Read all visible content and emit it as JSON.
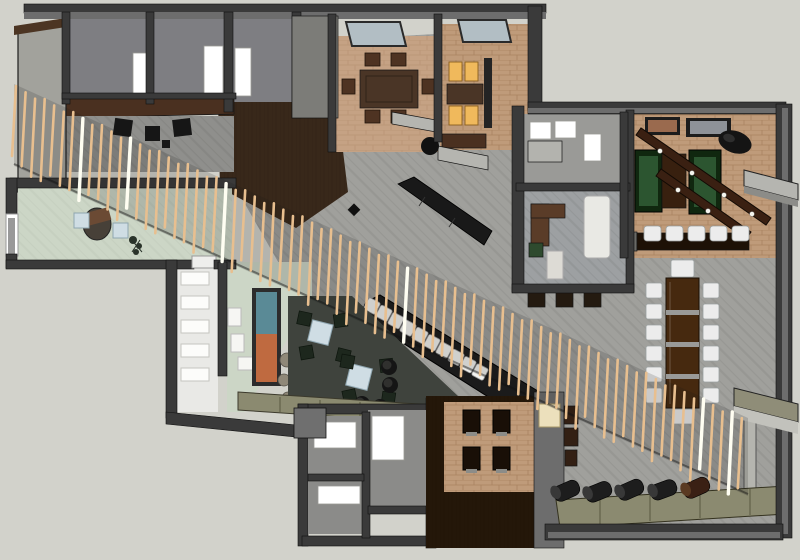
{
  "meta": {
    "title": "Restaurant interior 3D floor plan render",
    "view": "top-down axonometric cutaway",
    "width_px": 800,
    "height_px": 560
  },
  "colors": {
    "bg": "#d2d2cb",
    "wallDark": "#3a3a3a",
    "wallMid": "#6d6d6d",
    "wallLight": "#a2a29c",
    "floorGray": "#a0a09c",
    "floorRoom": "#7e7e82",
    "carpet": "#c5a284",
    "brick": "#bf9b7a",
    "sage": "#ccd6c6",
    "loungeFloor": "#3f433d",
    "woodFloor": "#38281a",
    "woodBand": "#4a3020",
    "woodTable": "#4a3526",
    "woodDeep": "#241709",
    "blackFurn": "#161616",
    "chairWhite": "#ececec",
    "chairGreen": "#1d271d",
    "greenTableOuter": "#10270f",
    "greenTableInner": "#2c5530",
    "amber": "#f0b95c",
    "olive": "#8b8a70",
    "blueTable": "#cfdde4",
    "glass": "#b2bec4",
    "slat": "#e8bf8f",
    "slatLight": "#fffef2",
    "paintingTeal": "#5a8a96",
    "paintingOrange": "#bf6a40",
    "stone": "#8f8878",
    "cream": "#ece0bc"
  },
  "scene": {
    "description": "Cutaway overhead render of a restaurant/lounge interior with a diagonal timber-slat screen crossing the plan from upper-left to lower-right",
    "rooms": [
      {
        "name": "kitchen-back-rooms",
        "features": [
          "three white door openings",
          "dark wood service counter",
          "three dark stools"
        ]
      },
      {
        "name": "private-dining-room",
        "features": [
          "rectangular wood table",
          "six wood chairs",
          "skylight"
        ]
      },
      {
        "name": "booth-room",
        "features": [
          "four lit amber booth cushions",
          "wood booth table",
          "skylight"
        ]
      },
      {
        "name": "hostess-area",
        "features": [
          "two gray counters",
          "round black table",
          "long black bench"
        ]
      },
      {
        "name": "service-room",
        "features": [
          "white cabinets",
          "L-shaped counter"
        ]
      },
      {
        "name": "office-lounge-room",
        "features": [
          "brown L-sofa",
          "white sofa",
          "green chair",
          "white table"
        ]
      },
      {
        "name": "games-room",
        "features": [
          "two green shuffleboard tables",
          "dark wood table",
          "two overhead light beams",
          "two wall pictures",
          "black drum light"
        ]
      },
      {
        "name": "games-bar",
        "features": [
          "dark counter",
          "five white stools"
        ]
      },
      {
        "name": "communal-table",
        "features": [
          "long dark wood table",
          "twelve white side chairs",
          "two head chairs"
        ]
      },
      {
        "name": "sushi-bar",
        "features": [
          "diagonal black counter",
          "ten white chairs"
        ]
      },
      {
        "name": "reception",
        "features": [
          "curved desk",
          "two light blue tables",
          "plant",
          "entry door"
        ]
      },
      {
        "name": "lounge",
        "features": [
          "two light blue tables",
          "eight green chairs",
          "four black poufs",
          "artwork wall",
          "stone feature",
          "olive banquette",
          "white stair treads"
        ]
      },
      {
        "name": "restrooms",
        "features": [
          "two rooms",
          "white fixtures"
        ]
      },
      {
        "name": "booth-alcove",
        "features": [
          "four dark booths",
          "cream cushion column",
          "three brown seats"
        ]
      },
      {
        "name": "rear-lounge",
        "features": [
          "five cylinder poufs",
          "olive bench",
          "two exterior canopies"
        ]
      }
    ]
  },
  "slats": {
    "count": 77,
    "x0": 16,
    "dx": 9.55,
    "y0": 88,
    "slope": 0.455,
    "length": 70,
    "lean": -4,
    "light_indices": [
      7,
      12,
      22,
      41,
      72,
      75
    ]
  },
  "communal": {
    "chair_columns": [
      {
        "x": 646
      },
      {
        "x": 703
      }
    ],
    "chair_ys": [
      283,
      304,
      325,
      346,
      367,
      388
    ],
    "w": 16,
    "h": 15
  },
  "sushi": {
    "count": 10,
    "x0": 372,
    "y0": 306,
    "x1": 480,
    "y1": 372,
    "size": 13,
    "angle": 28
  },
  "poufs": [
    {
      "x": 566,
      "y": 491,
      "rot": -24
    },
    {
      "x": 598,
      "y": 492,
      "rot": -22
    },
    {
      "x": 630,
      "y": 490,
      "rot": -24
    },
    {
      "x": 663,
      "y": 490,
      "rot": -20
    },
    {
      "x": 696,
      "y": 488,
      "rot": -24,
      "brown": true
    }
  ]
}
